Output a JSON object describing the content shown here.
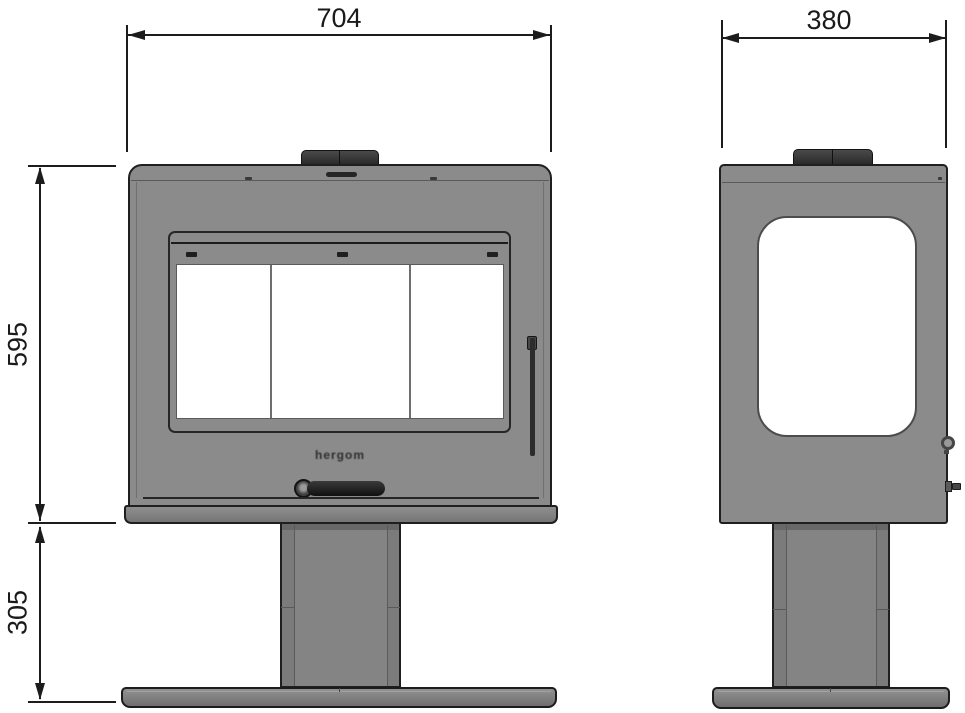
{
  "drawing": {
    "brand": {
      "logo_text": "hergom"
    },
    "dimensions": {
      "front_width": {
        "label": "704"
      },
      "side_depth": {
        "label": "380"
      },
      "firebox_height": {
        "label": "595"
      },
      "pedestal_height": {
        "label": "305"
      }
    },
    "colors": {
      "line_black": "#1c1c1c",
      "body_gray": "#8b8b8b",
      "pedestal_gray": "#7b7b7b",
      "collar_dark": "#333333",
      "handle_dark": "#1b1b1b",
      "glass_white": "#ffffff",
      "background": "#ffffff"
    }
  }
}
